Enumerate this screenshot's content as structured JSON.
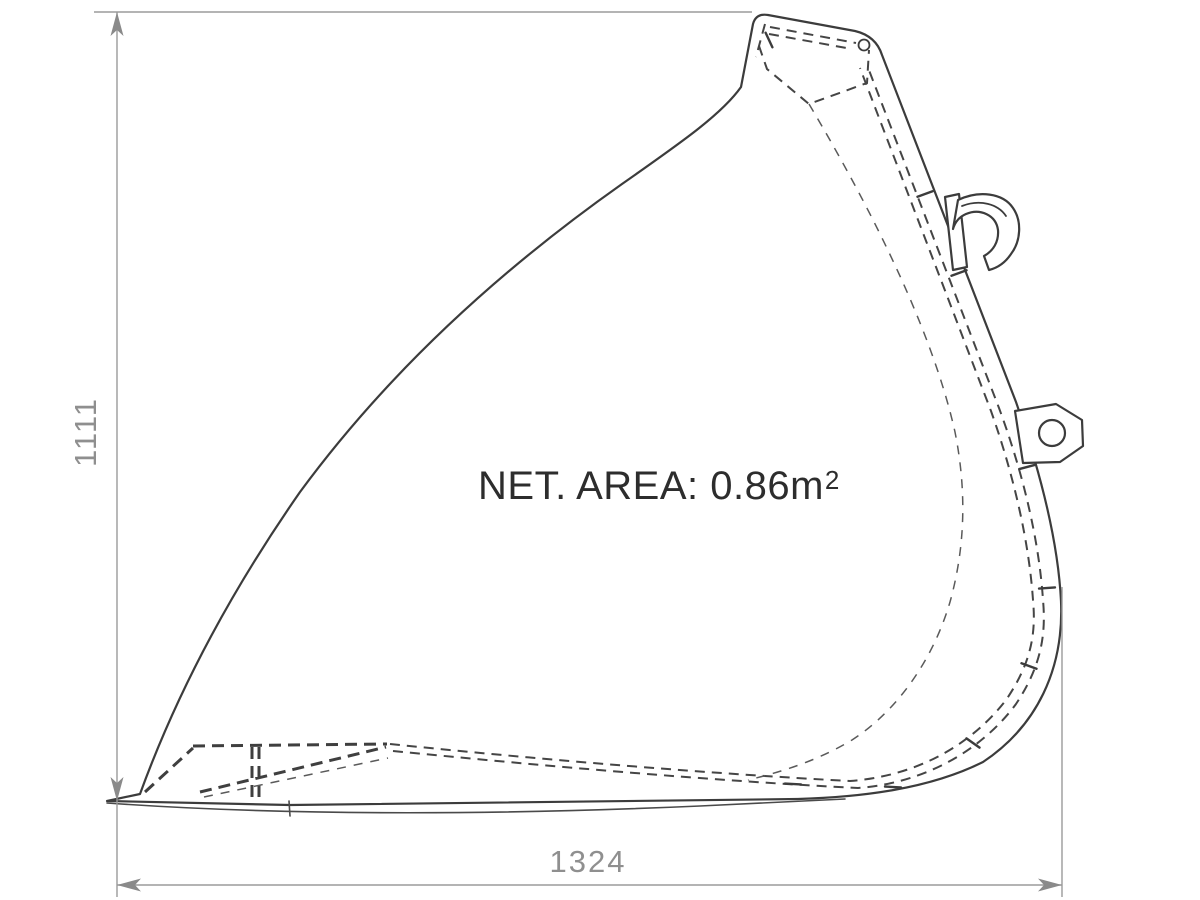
{
  "drawing": {
    "subject": "loader-bucket-side-profile-technical-drawing",
    "annotation": {
      "net_area_label": "NET. AREA: 0.86m",
      "net_area_exponent": "2",
      "net_area_full_text": "NET. AREA: 0.86m²"
    },
    "dimensions": {
      "height_mm": "1111",
      "width_mm": "1324"
    },
    "colors": {
      "background": "#ffffff",
      "drawing_line": "#3c3c3c",
      "hidden_line": "#454545",
      "dimension_line": "#9b9b9b",
      "dimension_text": "#8f8f8f",
      "annotation_text": "#2d2d2d"
    }
  }
}
